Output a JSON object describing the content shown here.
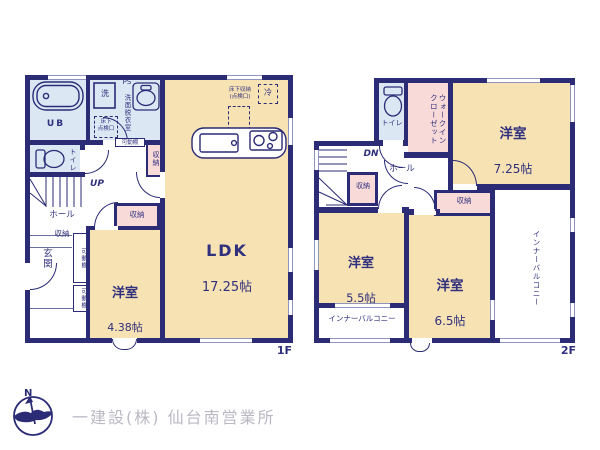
{
  "floor1": {
    "label": "1F",
    "ldk_name": "LDK",
    "ldk_size": "17.25帖",
    "bedroom_name": "洋室",
    "bedroom_size": "4.38帖",
    "bath": "UB",
    "washer": "洗",
    "ps": "PS",
    "washroom": "洗面脱衣室",
    "underfloor_wash": "床下\n点検口",
    "toilet": "トイレ",
    "up": "UP",
    "hall": "ホール",
    "entrance": "玄関",
    "storage": "収納",
    "shelf": "可動棚",
    "underfloor_kitchen": "床下収納\n(点検口)",
    "fridge": "冷"
  },
  "floor2": {
    "label": "2F",
    "bedroom1_name": "洋室",
    "bedroom1_size": "7.25帖",
    "bedroom2_name": "洋室",
    "bedroom2_size": "5.5帖",
    "bedroom3_name": "洋室",
    "bedroom3_size": "6.5帖",
    "wic": "ウォークイン\nクローゼット",
    "toilet": "トイレ",
    "dn": "DN",
    "hall": "ホール",
    "storage": "収納",
    "balcony": "インナーバルコニー"
  },
  "footer": {
    "compass_n": "N",
    "company": "一建設(株) 仙台南営業所"
  },
  "colors": {
    "wall": "#2b2b76",
    "room_cream": "#f7e2b4",
    "wet_blue": "#dbe8f4",
    "closet_pink": "#f8dbd8",
    "text_navy": "#30307d",
    "footer_gray": "#b9b9c3"
  }
}
